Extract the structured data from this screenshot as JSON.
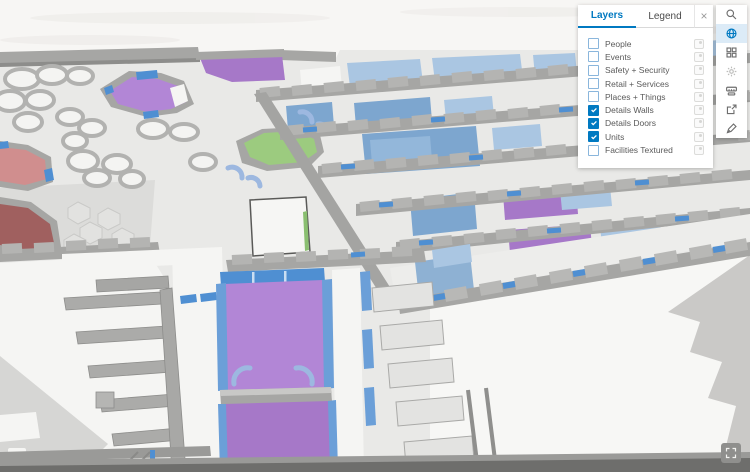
{
  "panel": {
    "tabs": [
      {
        "label": "Layers",
        "active": true
      },
      {
        "label": "Legend",
        "active": false
      }
    ],
    "close_glyph": "×",
    "layers": [
      {
        "label": "People",
        "checked": false
      },
      {
        "label": "Events",
        "checked": false
      },
      {
        "label": "Safety + Security",
        "checked": false
      },
      {
        "label": "Retail + Services",
        "checked": false
      },
      {
        "label": "Places + Things",
        "checked": false
      },
      {
        "label": "Details Walls",
        "checked": true
      },
      {
        "label": "Details Doors",
        "checked": true
      },
      {
        "label": "Units",
        "checked": true
      },
      {
        "label": "Facilities Textured",
        "checked": false
      }
    ]
  },
  "toolbar": {
    "tools": [
      {
        "name": "search",
        "active": false
      },
      {
        "name": "basemap",
        "active": true
      },
      {
        "name": "apps",
        "active": false
      },
      {
        "name": "settings",
        "active": false
      },
      {
        "name": "measure",
        "active": false
      },
      {
        "name": "share",
        "active": false
      },
      {
        "name": "sketch",
        "active": false
      }
    ]
  },
  "map": {
    "description": "3D isometric indoor floor plan scene",
    "room_colors": {
      "units_purple": "#b286d6",
      "units_green": "#9ccb7f",
      "units_red_light": "#d08e8e",
      "units_red_dark": "#a0605f",
      "units_blue": "#7da6cf"
    }
  },
  "colors": {
    "accent_blue": "#0079c1",
    "toolbar_active_bg": "#dcebf7",
    "room_purple": "#b286d6",
    "room_purple_dark": "#a678c8",
    "room_green": "#9ccb7f",
    "room_red_light": "#d08e8e",
    "room_red_dark": "#a0605f",
    "floor_blue": "#7da6cf",
    "floor_blue_light": "#aac6e2",
    "door_blue": "#4f8fd2",
    "wall_gray": "#a6a6a4",
    "wall_gray_dark": "#8d8d8b",
    "floor_gray": "#e9e9e7",
    "ground_white": "#f7f7f5"
  }
}
